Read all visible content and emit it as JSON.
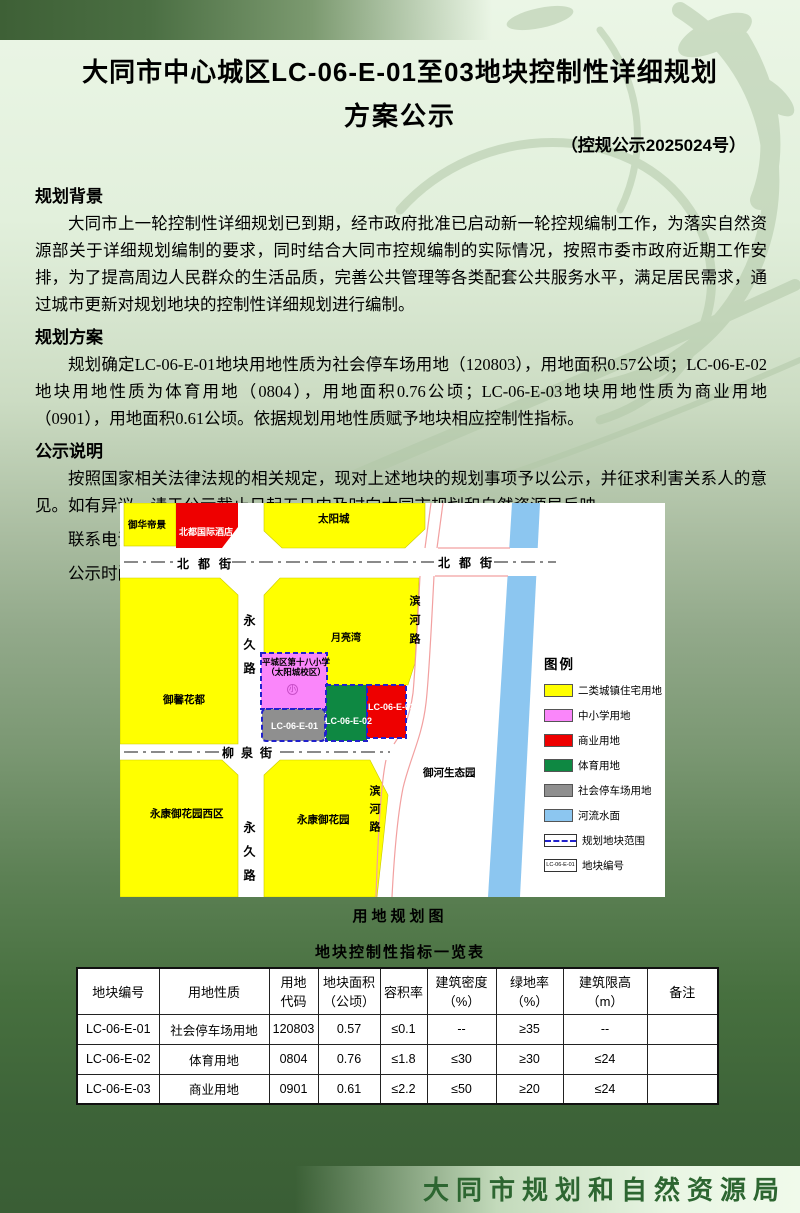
{
  "doc": {
    "title_line1": "大同市中心城区LC-06-E-01至03地块控制性详细规划",
    "title_line2": "方案公示",
    "subtitle": "（控规公示2025024号）",
    "sections": [
      {
        "heading": "规划背景",
        "body": "大同市上一轮控制性详细规划已到期，经市政府批准已启动新一轮控规编制工作，为落实自然资源部关于详细规划编制的要求，同时结合大同市控规编制的实际情况，按照市委市政府近期工作安排，为了提高周边人民群众的生活品质，完善公共管理等各类配套公共服务水平，满足居民需求，通过城市更新对规划地块的控制性详细规划进行编制。"
      },
      {
        "heading": "规划方案",
        "body": "规划确定LC-06-E-01地块用地性质为社会停车场用地（120803），用地面积0.57公顷；LC-06-E-02地块用地性质为体育用地（0804），用地面积0.76公顷；LC-06-E-03地块用地性质为商业用地（0901），用地面积0.61公顷。依据规划用地性质赋予地块相应控制性指标。"
      },
      {
        "heading": "公示说明",
        "body": "按照国家相关法律法规的相关规定，现对上述地块的规划事项予以公示，并征求利害关系人的意见。如有异议，请于公示截止日起五日内及时向大同市规划和自然资源局反映。"
      }
    ],
    "contact_phone": "联系电话：0352-7789834",
    "notice_period": "公示时间：2025年07月28日至2025年08月26日",
    "footer": "大同市规划和自然资源局"
  },
  "map": {
    "caption": "用地规划图",
    "street_names": {
      "beidu_left": "北都街",
      "beidu_right": "北都街",
      "yongjiu_upper": "永久路",
      "yongjiu_lower": "永久路",
      "liuquan": "柳泉街",
      "binhe_upper": "滨河路",
      "binhe_lower": "滨河路"
    },
    "parcel_labels": {
      "yuhua": "御华帝景",
      "hotel": "北都国际酒店",
      "taiyangcheng": "太阳城",
      "yueliangwan": "月亮湾",
      "school_line1": "平城区第十八小学",
      "school_line2": "（太阳城校区）",
      "school_mark": "小",
      "yuxin": "御馨花都",
      "yongkang_west": "永康御花园西区",
      "yongkang": "永康御花园",
      "yuhe_park": "御河生态园"
    },
    "blocks": {
      "b01": "LC-06-E-01",
      "b02": "LC-06-E-02",
      "b03": "LC-06-E-03"
    },
    "legend": {
      "title": "图例",
      "items": [
        {
          "label": "二类城镇住宅用地",
          "color": "#ffff00"
        },
        {
          "label": "中小学用地",
          "color": "#fa86fa"
        },
        {
          "label": "商业用地",
          "color": "#ee0000"
        },
        {
          "label": "体育用地",
          "color": "#0e8842"
        },
        {
          "label": "社会停车场用地",
          "color": "#8f8f8f"
        },
        {
          "label": "河流水面",
          "color": "#8cc6f0"
        },
        {
          "label": "规划地块范围",
          "color": "#2121cc"
        },
        {
          "label": "地块编号",
          "sample": "LC-06-E-01"
        }
      ]
    }
  },
  "table": {
    "title": "地块控制性指标一览表",
    "headers": [
      "地块编号",
      "用地性质",
      "用地\n代码",
      "地块面积\n（公顷）",
      "容积率",
      "建筑密度\n（%）",
      "绿地率\n（%）",
      "建筑限高\n（m）",
      "备注"
    ],
    "rows": [
      [
        "LC-06-E-01",
        "社会停车场用地",
        "120803",
        "0.57",
        "≤0.1",
        "--",
        "≥35",
        "--",
        ""
      ],
      [
        "LC-06-E-02",
        "体育用地",
        "0804",
        "0.76",
        "≤1.8",
        "≤30",
        "≥30",
        "≤24",
        ""
      ],
      [
        "LC-06-E-03",
        "商业用地",
        "0901",
        "0.61",
        "≤2.2",
        "≤50",
        "≥20",
        "≤24",
        ""
      ]
    ]
  },
  "colors": {
    "page_top": "#ebf6e6",
    "page_bottom": "#3a5e35",
    "bar_green": "#3e6036",
    "footer_text": "#2d6631",
    "residential": "#ffff00",
    "school": "#fa86fa",
    "commercial": "#ee0000",
    "sports": "#0e8842",
    "parking": "#8f8f8f",
    "river": "#8cc6f0",
    "boundary_blue": "#2121cc"
  }
}
